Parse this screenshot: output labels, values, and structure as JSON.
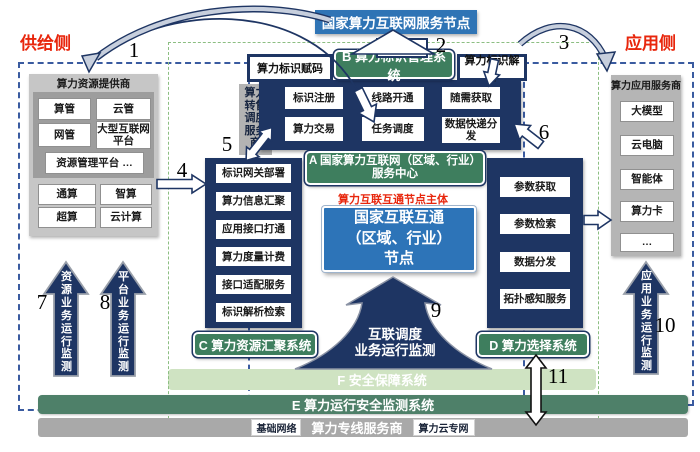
{
  "title": "国家算力互联网服务节点",
  "id_store": "标识库",
  "side": {
    "supply": "供给侧",
    "demand": "应用侧"
  },
  "b_row": {
    "assign": "算力标识赋码",
    "system": "B 算力标识管理系统",
    "resolve": "算力标识解析"
  },
  "reseller": "算力转售调度服务商",
  "a_system": {
    "items": [
      "标识注册",
      "线路开通",
      "随需获取",
      "算力交易",
      "任务调度",
      "数据快递分发"
    ],
    "label_line1": "A 国家算力互联网（区域、行业）",
    "label_line2": "服务中心"
  },
  "node": {
    "owner_note": "算力互联互通节点主体",
    "line1": "国家互联互通",
    "line2": "（区域、行业）",
    "line3": "节点"
  },
  "c_system": {
    "label": "C 算力资源汇聚系统",
    "items": [
      "标识网关部署",
      "算力信息汇聚",
      "应用接口打通",
      "算力度量计费",
      "接口适配服务",
      "标识解析检索"
    ]
  },
  "d_system": {
    "label": "D 算力选择系统",
    "items": [
      "参数获取",
      "参数检索",
      "数据分发",
      "拓扑感知服务"
    ]
  },
  "supply_panel": {
    "title": "算力资源提供商",
    "mgmt": [
      "算管",
      "云管",
      "网管",
      "大型互联网平台"
    ],
    "platform": "资源管理平台 …",
    "resources": [
      "通算",
      "智算",
      "超算",
      "云计算"
    ]
  },
  "app_panel": {
    "title": "算力应用服务商",
    "items": [
      "大模型",
      "云电脑",
      "智能体",
      "算力卡",
      "…"
    ]
  },
  "monitors": {
    "resource": "资源业务运行监测",
    "platform": "平台业务运行监测",
    "app": "应用业务运行监测",
    "interconnect_line1": "互联调度",
    "interconnect_line2": "业务运行监测"
  },
  "f_bar": "F 安全保障系统",
  "e_bar": "E 算力运行安全监测系统",
  "bottom_bar": {
    "base": "基础网络",
    "provider": "算力专线服务商",
    "cloud": "算力云专网"
  },
  "numbers": {
    "n1": "1",
    "n2": "2",
    "n3": "3",
    "n4": "4",
    "n5": "5",
    "n6": "6",
    "n7": "7",
    "n8": "8",
    "n9": "9",
    "n10": "10",
    "n11": "11"
  },
  "colors": {
    "navy": "#1e3563",
    "green": "#3e7e5e",
    "blue": "#2f74b5",
    "f_green": "#cfe3c2",
    "e_green": "#4e8069",
    "gray": "#a9a9a9",
    "red": "#e8260c"
  }
}
